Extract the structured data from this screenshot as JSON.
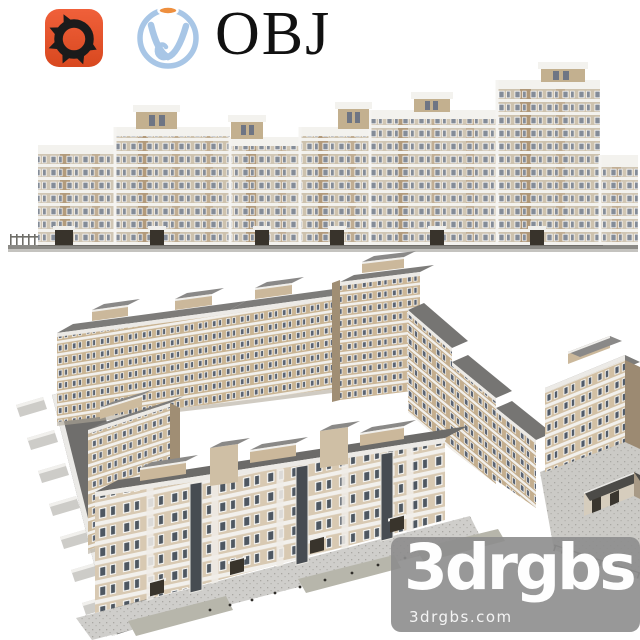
{
  "header": {
    "corona_icon": "corona-renderer-icon",
    "corona_color": "#e9522c",
    "vray_icon": "vray-icon",
    "vray_color": "#a8c6e6",
    "vray_accent": "#ee8f3e",
    "format_label": "OBJ"
  },
  "renders": {
    "elevation": {
      "name": "apartment-building-front-elevation",
      "facade_color": "#cdc0ac",
      "brick_color": "#a88c6a",
      "trim_color": "#f3f2ee",
      "glass_color": "#7d8591",
      "roof_color": "#7d7c7a"
    },
    "perspective": {
      "name": "apartment-complex-aerial-courtyard-view",
      "facade_color": "#d2c2a8",
      "shade_color": "#a08e74",
      "roof_color": "#6f6e6c",
      "pavement_color": "#cbcac6"
    }
  },
  "watermark": {
    "title": "3drgbs",
    "url": "3drgbs.com",
    "background": "#8d8d8d",
    "text_color": "#ffffff"
  }
}
